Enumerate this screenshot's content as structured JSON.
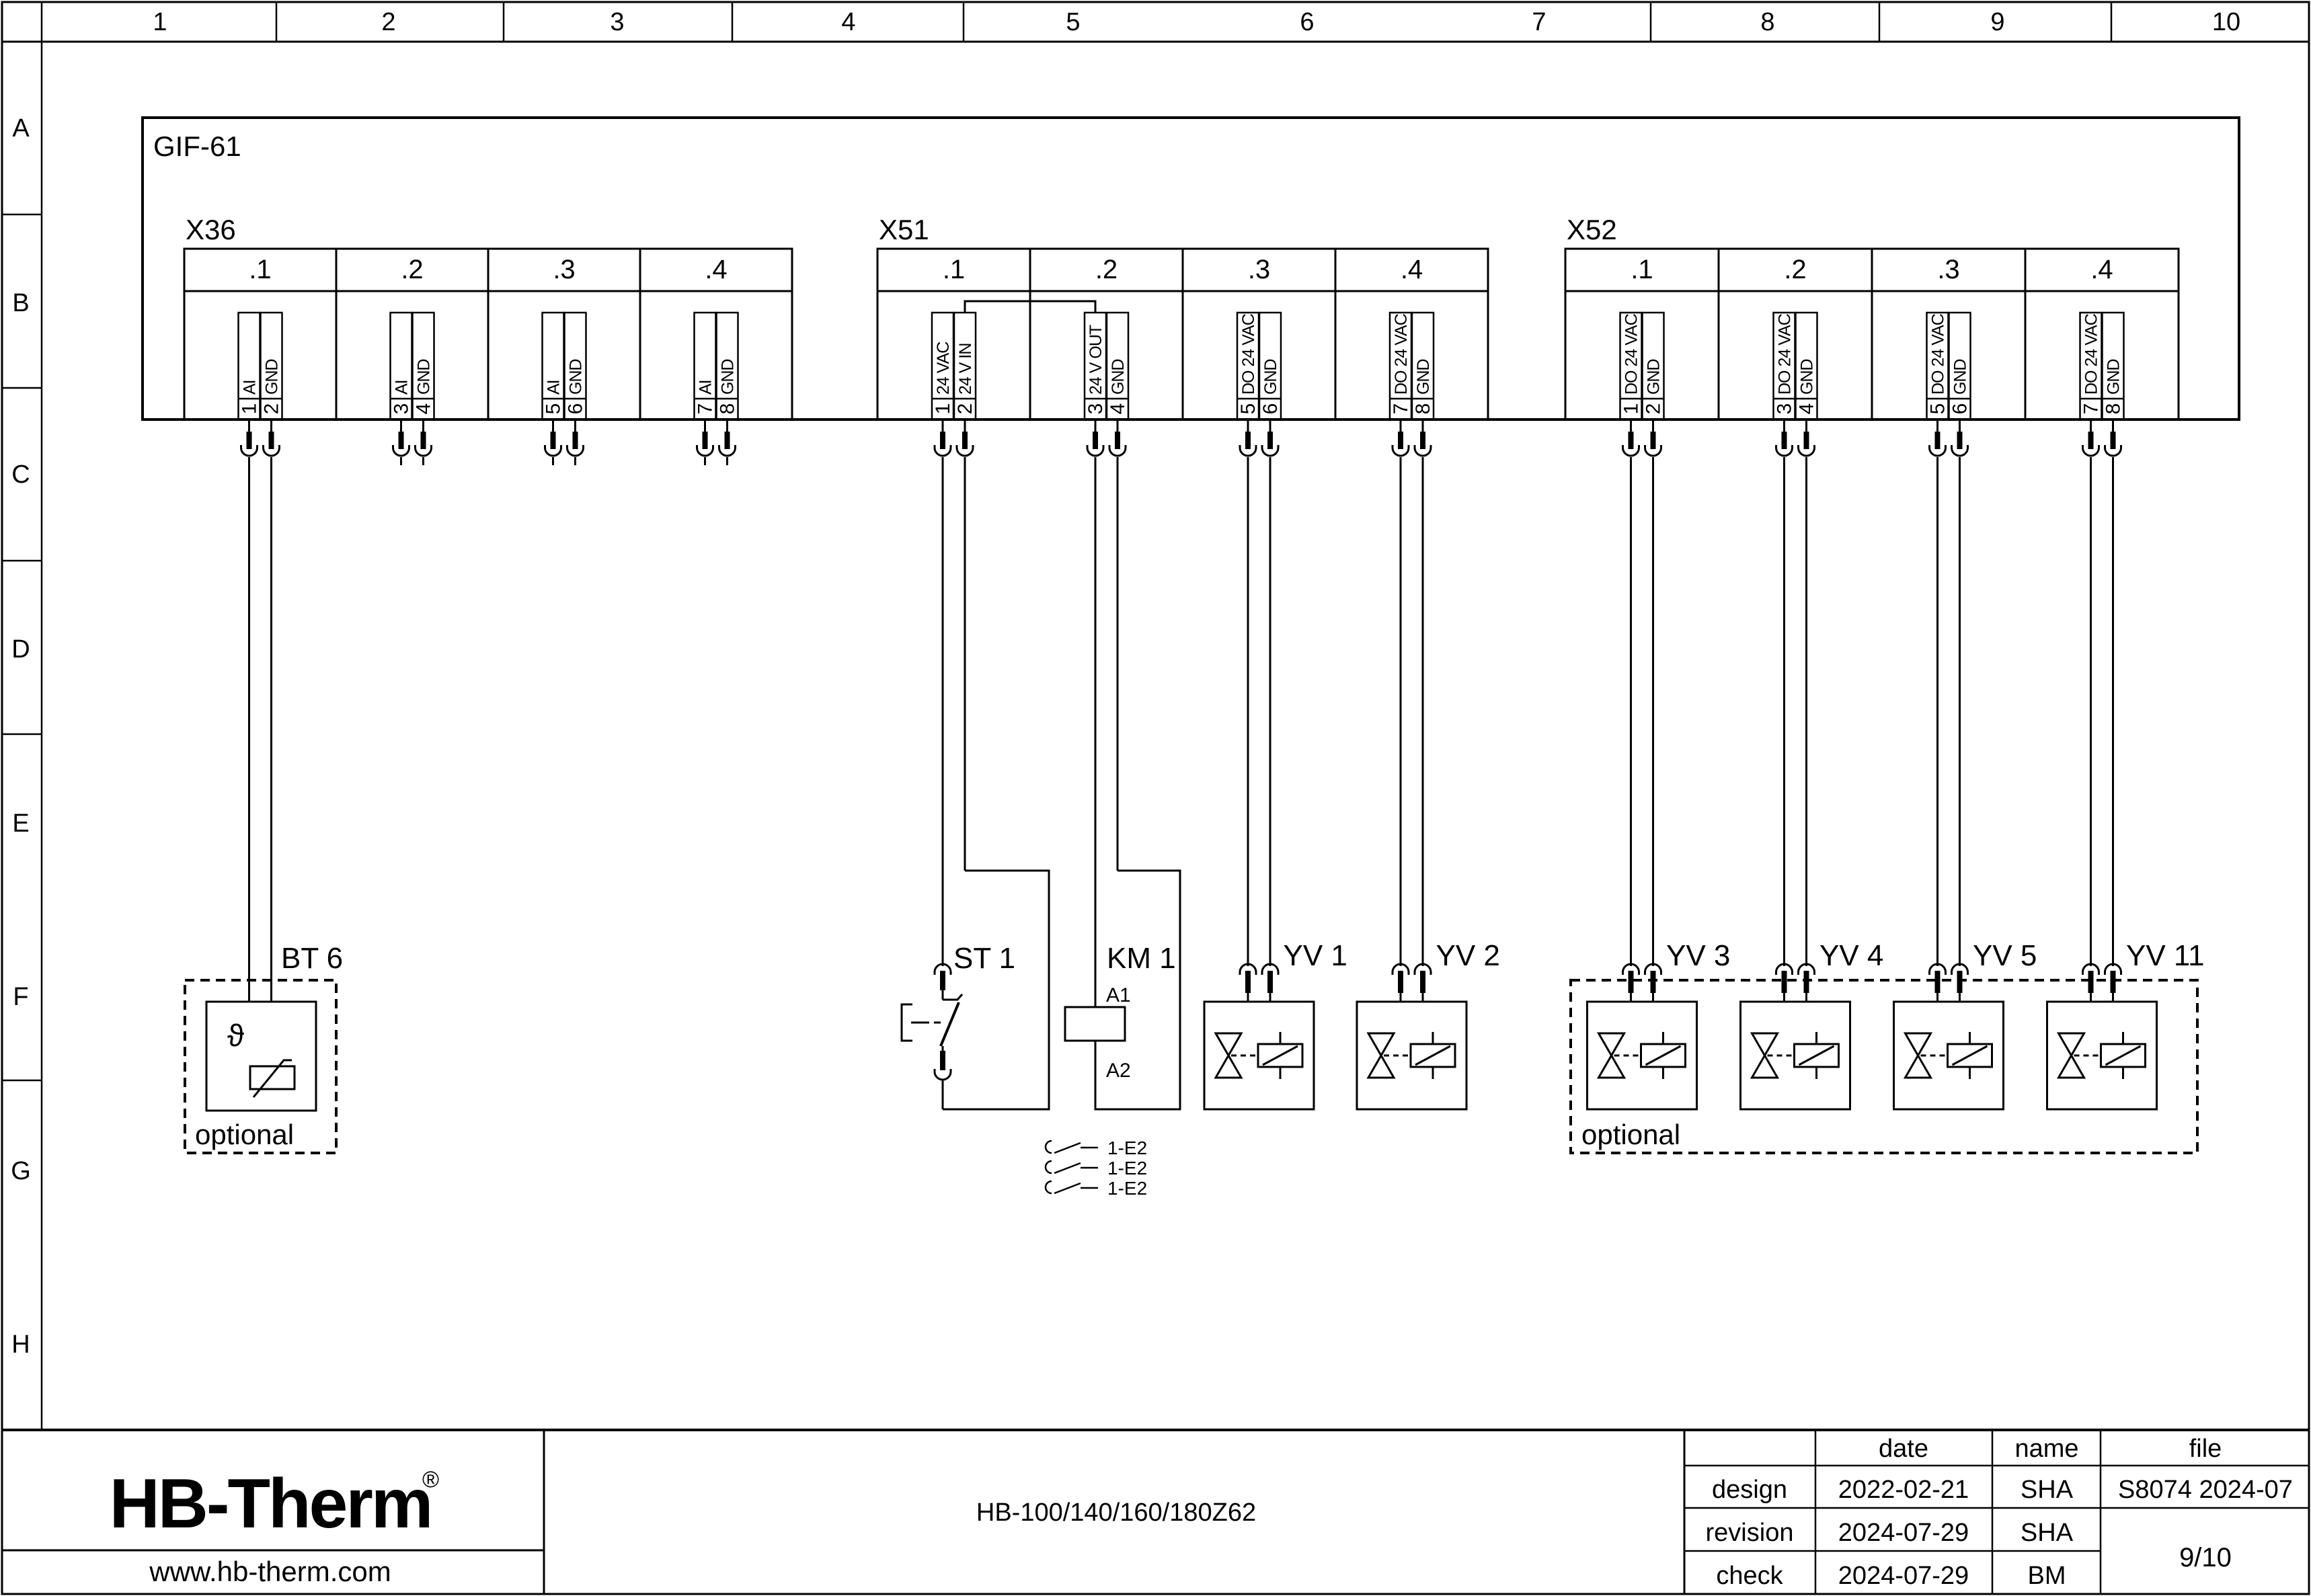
{
  "sheet": {
    "columns": [
      "1",
      "2",
      "3",
      "4",
      "5",
      "6",
      "7",
      "8",
      "9",
      "10"
    ],
    "rows": [
      "A",
      "B",
      "C",
      "D",
      "E",
      "F",
      "G",
      "H"
    ]
  },
  "module": {
    "label": "GIF-61"
  },
  "connectors": [
    {
      "label": "X36",
      "sections": [
        {
          "label": ".1",
          "pins": [
            {
              "no": "1",
              "signal": "AI"
            },
            {
              "no": "2",
              "signal": "GND"
            }
          ]
        },
        {
          "label": ".2",
          "pins": [
            {
              "no": "3",
              "signal": "AI"
            },
            {
              "no": "4",
              "signal": "GND"
            }
          ]
        },
        {
          "label": ".3",
          "pins": [
            {
              "no": "5",
              "signal": "AI"
            },
            {
              "no": "6",
              "signal": "GND"
            }
          ]
        },
        {
          "label": ".4",
          "pins": [
            {
              "no": "7",
              "signal": "AI"
            },
            {
              "no": "8",
              "signal": "GND"
            }
          ]
        }
      ]
    },
    {
      "label": "X51",
      "sections": [
        {
          "label": ".1",
          "pins": [
            {
              "no": "1",
              "signal": "24 VAC"
            },
            {
              "no": "2",
              "signal": "24 V IN"
            }
          ]
        },
        {
          "label": ".2",
          "pins": [
            {
              "no": "3",
              "signal": "24 V OUT"
            },
            {
              "no": "4",
              "signal": "GND"
            }
          ]
        },
        {
          "label": ".3",
          "pins": [
            {
              "no": "5",
              "signal": "DO 24 VAC"
            },
            {
              "no": "6",
              "signal": "GND"
            }
          ]
        },
        {
          "label": ".4",
          "pins": [
            {
              "no": "7",
              "signal": "DO 24 VAC"
            },
            {
              "no": "8",
              "signal": "GND"
            }
          ]
        }
      ]
    },
    {
      "label": "X52",
      "sections": [
        {
          "label": ".1",
          "pins": [
            {
              "no": "1",
              "signal": "DO 24 VAC"
            },
            {
              "no": "2",
              "signal": "GND"
            }
          ]
        },
        {
          "label": ".2",
          "pins": [
            {
              "no": "3",
              "signal": "DO 24 VAC"
            },
            {
              "no": "4",
              "signal": "GND"
            }
          ]
        },
        {
          "label": ".3",
          "pins": [
            {
              "no": "5",
              "signal": "DO 24 VAC"
            },
            {
              "no": "6",
              "signal": "GND"
            }
          ]
        },
        {
          "label": ".4",
          "pins": [
            {
              "no": "7",
              "signal": "DO 24 VAC"
            },
            {
              "no": "8",
              "signal": "GND"
            }
          ]
        }
      ]
    }
  ],
  "components": {
    "bt6": {
      "label": "BT 6",
      "theta_symbol": "ϑ",
      "optional_label": "optional"
    },
    "st1": {
      "label": "ST 1"
    },
    "km1": {
      "label": "KM 1",
      "coil_top": "A1",
      "coil_bottom": "A2",
      "contact_refs": [
        "1-E2",
        "1-E2",
        "1-E2"
      ]
    },
    "valves": [
      {
        "label": "YV 1"
      },
      {
        "label": "YV 2"
      },
      {
        "label": "YV 3"
      },
      {
        "label": "YV 4"
      },
      {
        "label": "YV 5"
      },
      {
        "label": "YV 11"
      }
    ],
    "valves_optional_label": "optional"
  },
  "title_block": {
    "logo_text": "HB-Therm",
    "logo_reg": "®",
    "logo_color": "#1b2240",
    "website": "www.hb-therm.com",
    "drawing_title": "HB-100/140/160/180Z62",
    "table": {
      "col_headers": [
        "date",
        "name",
        "file"
      ],
      "rows": [
        {
          "label": "design",
          "date": "2022-02-21",
          "name": "SHA"
        },
        {
          "label": "revision",
          "date": "2024-07-29",
          "name": "SHA"
        },
        {
          "label": "check",
          "date": "2024-07-29",
          "name": "BM"
        }
      ],
      "file_value": "S8074 2024-07",
      "page_indicator": "9/10"
    }
  }
}
